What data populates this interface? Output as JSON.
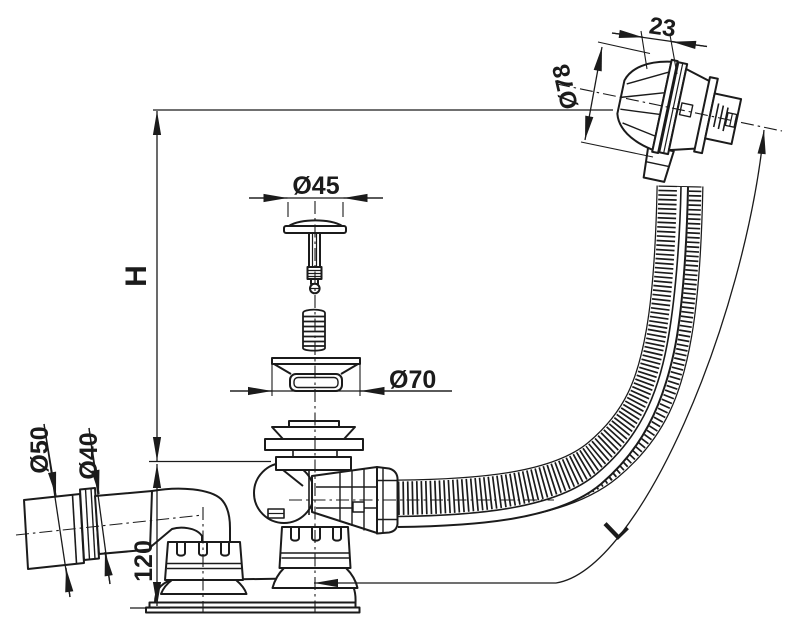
{
  "drawing": {
    "labels": {
      "height": "H",
      "length": "L",
      "base_height": "120",
      "overflow_face_width": "23",
      "overflow_diameter": "Ø78",
      "plug_cap_diameter": "Ø45",
      "waste_flange_diameter": "Ø70",
      "outlet_pipe_outer_diameter": "Ø50",
      "outlet_pipe_inner_diameter": "Ø40"
    },
    "colors": {
      "line": "#1b1b1b",
      "background": "#ffffff"
    }
  }
}
